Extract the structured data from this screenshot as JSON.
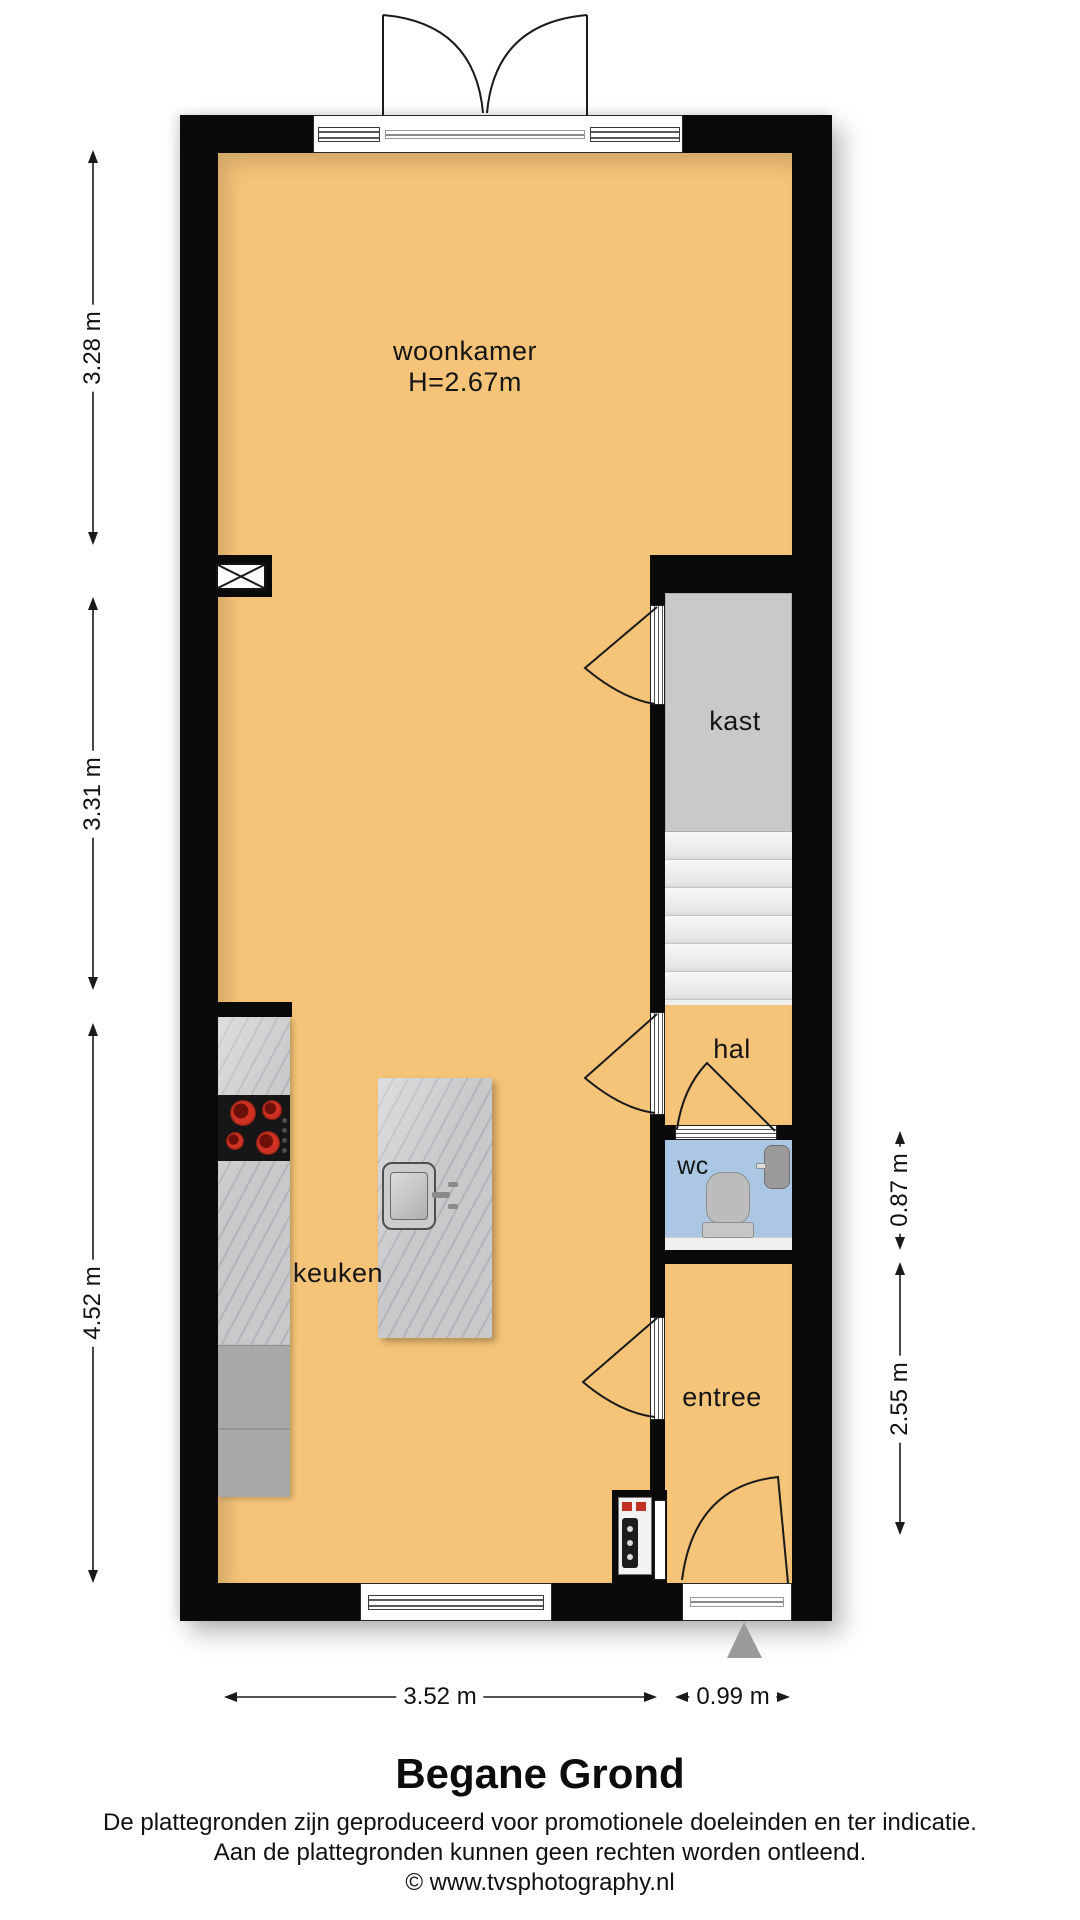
{
  "plan": {
    "rooms": {
      "woonkamer": {
        "label": "woonkamer",
        "height_note": "H=2.67m"
      },
      "kast": {
        "label": "kast"
      },
      "hal": {
        "label": "hal"
      },
      "wc": {
        "label": "wc"
      },
      "keuken": {
        "label": "keuken"
      },
      "entree": {
        "label": "entree"
      }
    },
    "dimensions": {
      "left": [
        "3.28 m",
        "3.31 m",
        "4.52 m"
      ],
      "right": [
        "0.87 m",
        "2.55 m"
      ],
      "bottom": [
        "3.52 m",
        "0.99 m"
      ]
    }
  },
  "footer": {
    "title": "Begane Grond",
    "disclaimer_line1": "De plattegronden zijn geproduceerd voor promotionele doeleinden en ter indicatie.",
    "disclaimer_line2": "Aan de plattegronden kunnen geen rechten worden ontleend.",
    "credit": "© www.tvsphotography.nl"
  },
  "colors": {
    "floor": "#f6c478",
    "wall": "#0a0a0a",
    "kast_fill": "#c9c9c9",
    "stair_fill": "#efefef",
    "wc_fill": "#abc7e3",
    "counter_fill": "#c7c9cb",
    "cabinet_fill": "#a8a8a8",
    "fixture_fill": "#bcbcbc",
    "burner_red": "#cf3222",
    "entry_triangle": "#9a9a9a",
    "line": "#1a1a1a"
  }
}
